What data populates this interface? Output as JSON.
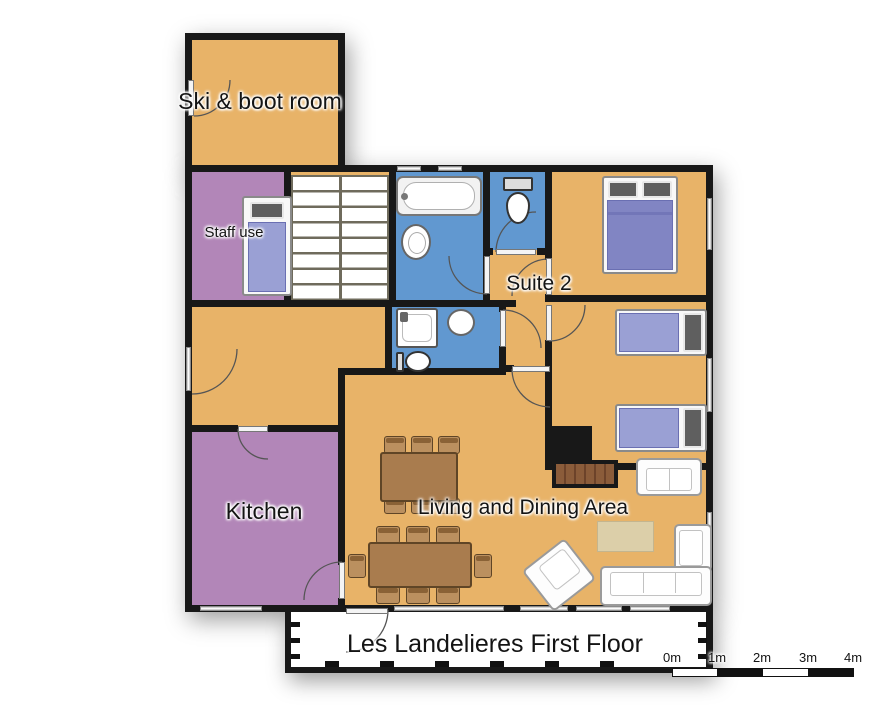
{
  "plan": {
    "title": "Les Landelieres First Floor",
    "room_labels": {
      "ski_boot_room": "Ski & boot room",
      "staff_room": "Staff use",
      "suite_2": "Suite 2",
      "kitchen": "Kitchen",
      "living_dining": "Living and Dining Area"
    },
    "scale_bar": {
      "labels": [
        "0m",
        "1m",
        "2m",
        "3m",
        "4m"
      ]
    },
    "colors": {
      "wall": "#181818",
      "room_orange": "#e8b368",
      "room_purple": "#b286b8",
      "room_blue": "#6198d0",
      "duvet_light": "#9aa0d4",
      "duvet_dark": "#8185c3",
      "pillow": "#5f5f5f",
      "wood": "#a97c4e",
      "wood_light": "#bb905f",
      "wood_dark": "#5f4526",
      "brick": "#8b5c3a",
      "brick_dark": "#6d432a",
      "rug": "#dccfa9"
    },
    "furniture_icons": [
      "single-bed-icon",
      "double-bed-icon",
      "twin-bed-icon",
      "bathtub-icon",
      "sink-icon",
      "toilet-icon",
      "shower-icon",
      "staircase-icon",
      "dining-table-icon",
      "chair-icon",
      "sofa-icon",
      "corner-sofa-icon",
      "armchair-icon",
      "rug-icon",
      "fireplace-icon"
    ]
  }
}
